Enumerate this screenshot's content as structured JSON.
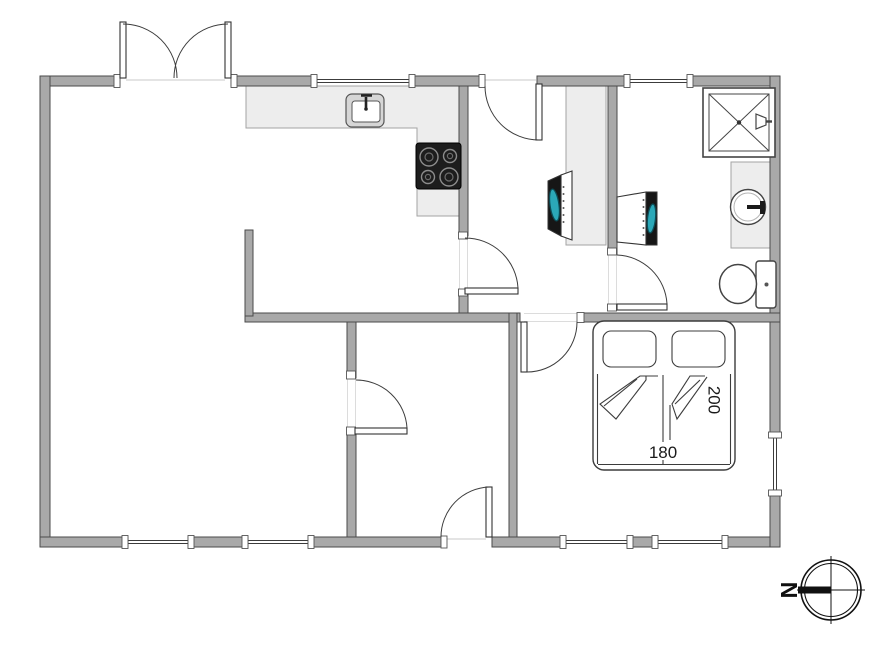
{
  "page": {
    "title": "Holiday home floor plan"
  },
  "labels": {
    "bed_width": "180",
    "bed_length": "200",
    "compass_north": "N"
  },
  "colors": {
    "wall_fill": "#a9a9a9",
    "wall_stroke": "#4a4a4a",
    "line": "#3c3c3c",
    "counter_fill": "#ededed",
    "counter_stroke": "#a3a3a3",
    "faint": "#dcdcdc",
    "appliance_dark": "#161616",
    "screen_teal": "#2ba8b8",
    "screen_teal_dark": "#0c4b55",
    "stove_fill": "#1d1d1d",
    "burner_ring": "#8c8c8c",
    "text_color": "#1a1a1a"
  },
  "icons": {
    "double_entry_door": "double-door-icon",
    "interior_door": "door-arc-icon",
    "window": "window-icon",
    "kitchen_sink": "sink-icon",
    "cooktop": "stove-icon",
    "wardrobe": "wardrobe-icon",
    "tv": "tv-icon",
    "washing_machine": "washing-machine-icon",
    "shower": "shower-icon",
    "washbasin": "washbasin-icon",
    "toilet": "toilet-icon",
    "double_bed": "double-bed-icon",
    "compass": "compass-rose-icon"
  }
}
